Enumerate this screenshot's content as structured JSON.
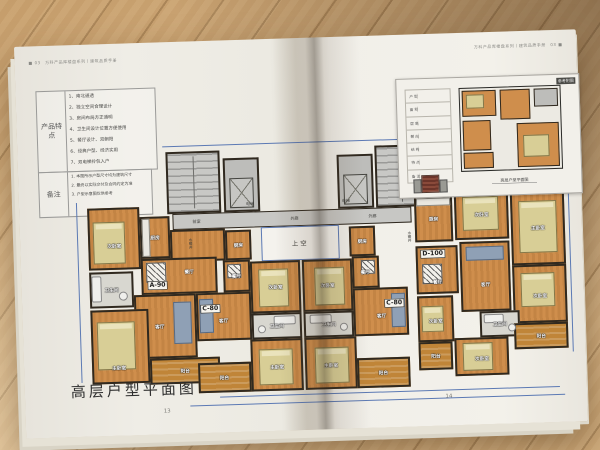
{
  "colors": {
    "wood": "#c9a470",
    "paper": "#edebe4",
    "room_fill": "#cf8e4c",
    "balcony_fill": "#c08538",
    "core_fill": "#bdbdba",
    "wall": "#30291f",
    "dimension_line": "#5b79b4",
    "bed_fill": "#d8ce96",
    "sofa_fill": "#8fa0b5"
  },
  "page": {
    "left": {
      "header": "■ 03　万科产品库楼盘系列丨建筑品质手册",
      "page_number": "13",
      "caption": "高层户型平面图",
      "features": {
        "header": "产品特点",
        "items": [
          "1、南北通透",
          "2、独立空间合理设计",
          "3、房间布局方正通明",
          "4、卫生间设计位置方便使用",
          "5、餐厅设计、双朝阳",
          "6、经典户型、经济实用",
          "7、双电梯拎包入户"
        ]
      },
      "notes": {
        "header": "备注",
        "lines": [
          "1. 本图所示户型尺寸均为建筑尺寸",
          "2. 最终以实际交付及合同约定为准",
          "3. 户型示意图仅供参考"
        ]
      }
    },
    "right": {
      "header": "万科产品库楼盘系列丨建筑品质手册　03 ■",
      "page_number": "14",
      "inset": {
        "corner_label": "参考附图",
        "caption": "高层户型平面图",
        "rows": [
          "户 型",
          "面 积",
          "层 高",
          "朝 向",
          "结 构",
          "特 点",
          "备 注"
        ]
      }
    }
  },
  "plan": {
    "units": {
      "a90": "A-90",
      "c80": "C-80",
      "d100": "D-100"
    },
    "labels": {
      "master": "主卧室",
      "second": "次卧室",
      "living": "客厅",
      "dining": "餐厅",
      "kitchen": "厨房",
      "bath": "卫生间",
      "balcony": "阳台",
      "elevator": "电梯",
      "corridor": "外廊",
      "void_above": "上空",
      "lobby": "前室",
      "utility_shaft": "水暖井"
    }
  }
}
